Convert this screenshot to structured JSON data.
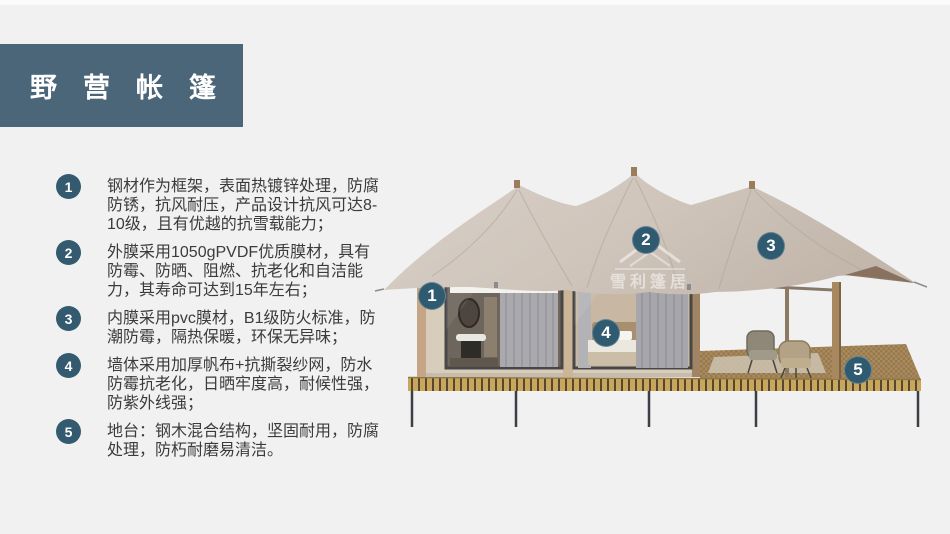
{
  "title": {
    "text": "野营帐篷"
  },
  "features": [
    {
      "num": "1",
      "text": "钢材作为框架，表面热镀锌处理，防腐防锈，抗风耐压，产品设计抗风可达8-10级，且有优越的抗雪载能力；"
    },
    {
      "num": "2",
      "text": "外膜采用1050gPVDF优质膜材，具有防霉、防晒、阻燃、抗老化和自洁能力，其寿命可达到15年左右；"
    },
    {
      "num": "3",
      "text": "内膜采用pvc膜材，B1级防火标准，防潮防霉，隔热保暖，环保无异味；"
    },
    {
      "num": "4",
      "text": "墙体采用加厚帆布+抗撕裂纱网，防水防霉抗老化，日晒牢度高，耐候性强，防紫外线强；"
    },
    {
      "num": "5",
      "text": "地台：钢木混合结构，坚固耐用，防腐处理，防朽耐磨易清洁。"
    }
  ],
  "diagram": {
    "watermark": {
      "text": "雪利篷居"
    },
    "markers": [
      {
        "num": "1"
      },
      {
        "num": "2"
      },
      {
        "num": "3"
      },
      {
        "num": "4"
      },
      {
        "num": "5"
      }
    ]
  },
  "colors": {
    "title_bg": "#4b6579",
    "badge": "#335a6e",
    "marker": "#2f5a70",
    "body_text": "#3b3b3b",
    "canvas_roof": "#cfc5bb",
    "wall": "#d8ccba",
    "deck_edge": "#c8a75d",
    "background": "#f1f1f2"
  }
}
